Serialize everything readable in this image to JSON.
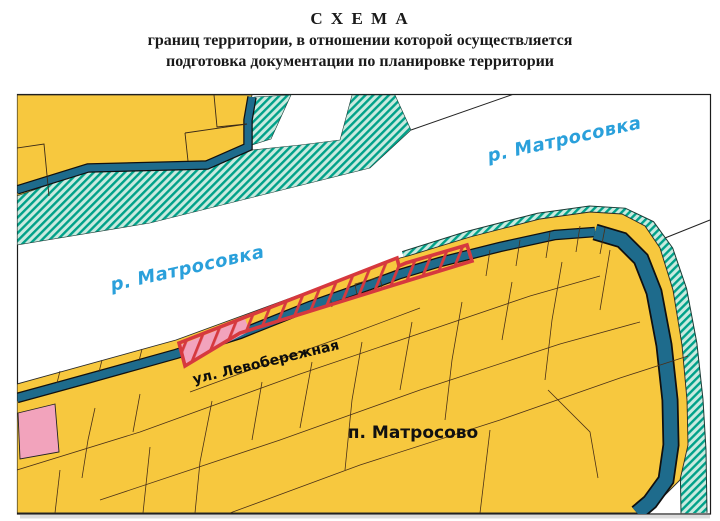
{
  "title": {
    "line1": "С Х Е М А",
    "line2": "границ территории, в отношении которой осуществляется",
    "line3": "подготовка документации по планировке территории"
  },
  "map": {
    "river_label_top": "р. Матросовка",
    "river_label_left": "р. Матросовка",
    "street_label": "ул. Левобережная",
    "settlement_label": "п. Матросово",
    "colors": {
      "parcel_yellow": "#F7C83E",
      "shore_hatch_stripe": "#00A189",
      "shore_hatch_bg": "#C9EADF",
      "channel_dark_teal": "#1E6B8C",
      "territory_boundary_red": "#D6393E",
      "territory_pink": "#F2A3BC",
      "river_label_blue": "#2AA0DB",
      "parcel_line_brown": "#4A3018",
      "river_white": "#FFFFFF"
    }
  }
}
